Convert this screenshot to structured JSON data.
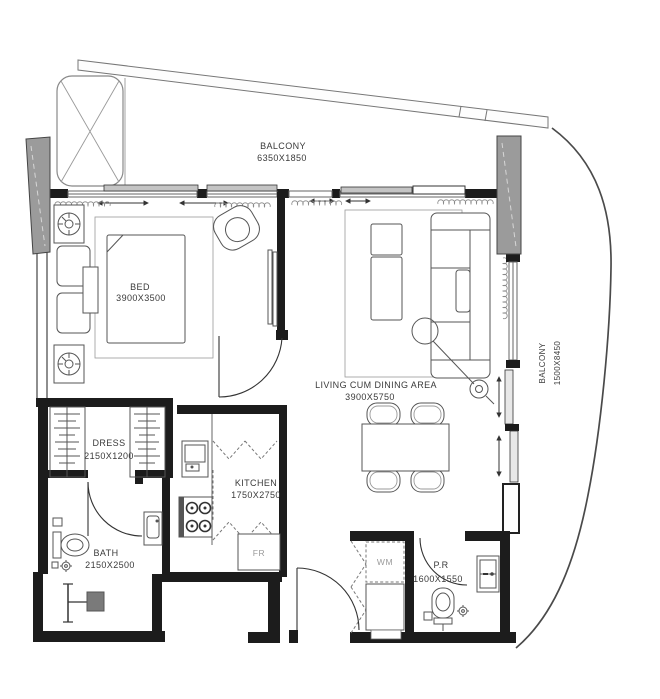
{
  "drawing": {
    "type": "apartment-floor-plan"
  },
  "rooms": {
    "balcony_top": {
      "label": "BALCONY",
      "dims": "6350X1850"
    },
    "bedroom": {
      "label": "BED",
      "dims": "3900X3500"
    },
    "living_dining": {
      "label": "LIVING CUM DINING AREA",
      "dims": "3900X5750"
    },
    "dress": {
      "label": "DRESS",
      "dims": "2150X1200"
    },
    "kitchen": {
      "label": "KITCHEN",
      "dims": "1750X2750"
    },
    "bath": {
      "label": "BATH",
      "dims": "2150X2500"
    },
    "powder_room": {
      "label": "P.R",
      "dims": "1600X1550"
    },
    "balcony_right": {
      "label": "BALCONY",
      "dims": "1500X8450"
    }
  },
  "appliances": {
    "washing_machine": "WM",
    "fridge": "FR"
  },
  "colors": {
    "wall": "#1c1c1c",
    "column": "#9b9b9b",
    "panel": "#c4c4c4",
    "furniture_line": "#555555",
    "label_text": "#3a3a3a",
    "appliance_text": "#9a9a9a"
  }
}
